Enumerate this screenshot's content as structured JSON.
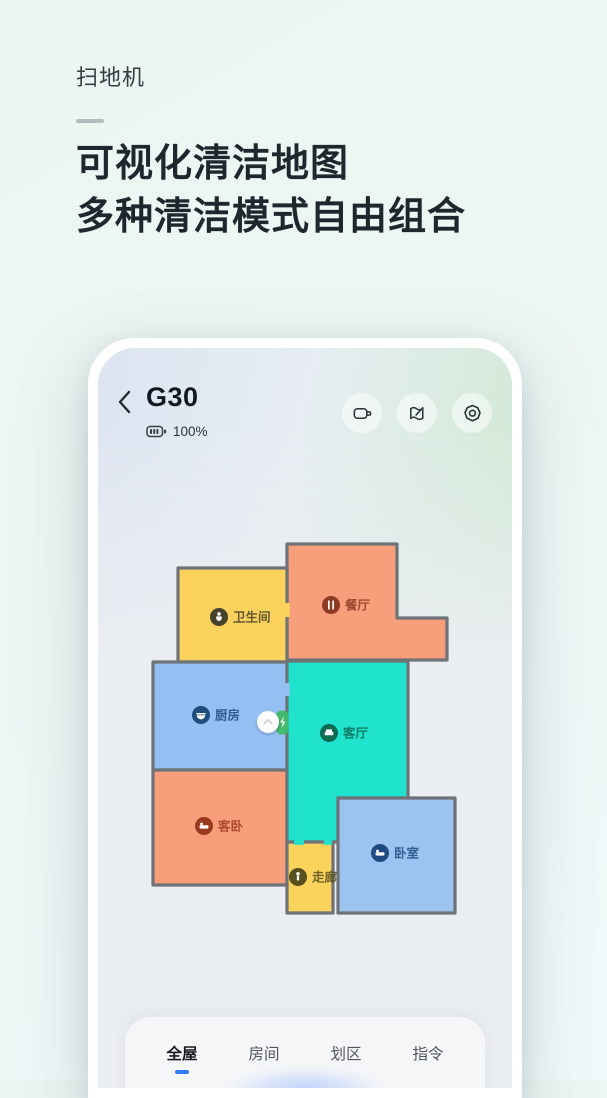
{
  "hero": {
    "eyebrow": "扫地机",
    "title_line1": "可视化清洁地图",
    "title_line2": "多种清洁模式自由组合"
  },
  "device": {
    "title": "G30",
    "battery": "100%",
    "toolbar": [
      {
        "icon": "video-camera-icon"
      },
      {
        "icon": "map-edit-icon"
      },
      {
        "icon": "settings-icon"
      }
    ]
  },
  "map": {
    "wall_color": "#6e7378",
    "robot_color": "#ffffff",
    "dock_color": "#43b96c",
    "rooms": [
      {
        "label": "餐厅",
        "icon": "dining-icon",
        "fill": "#f89e7b",
        "icon_bg": "#8e3b26"
      },
      {
        "label": "卫生间",
        "icon": "toilet-icon",
        "fill": "#fad25c",
        "icon_bg": "#45412a"
      },
      {
        "label": "厨房",
        "icon": "kitchen-icon",
        "fill": "#94bff2",
        "icon_bg": "#1d4d7d"
      },
      {
        "label": "客卧",
        "icon": "bed-icon",
        "fill": "#f89e7b",
        "icon_bg": "#9c3a20"
      },
      {
        "label": "客厅",
        "icon": "sofa-icon",
        "fill": "#1fe3cd",
        "icon_bg": "#0c6b50"
      },
      {
        "label": "走廊",
        "icon": "walker-icon",
        "fill": "#fad25c",
        "icon_bg": "#57511e"
      },
      {
        "label": "卧室",
        "icon": "bed-icon",
        "fill": "#9dc4f1",
        "icon_bg": "#1f4b82"
      }
    ]
  },
  "sheet": {
    "tabs": [
      {
        "label": "全屋",
        "active": true
      },
      {
        "label": "房间",
        "active": false
      },
      {
        "label": "划区",
        "active": false
      },
      {
        "label": "指令",
        "active": false
      }
    ],
    "accent": "#2f7bf6"
  }
}
